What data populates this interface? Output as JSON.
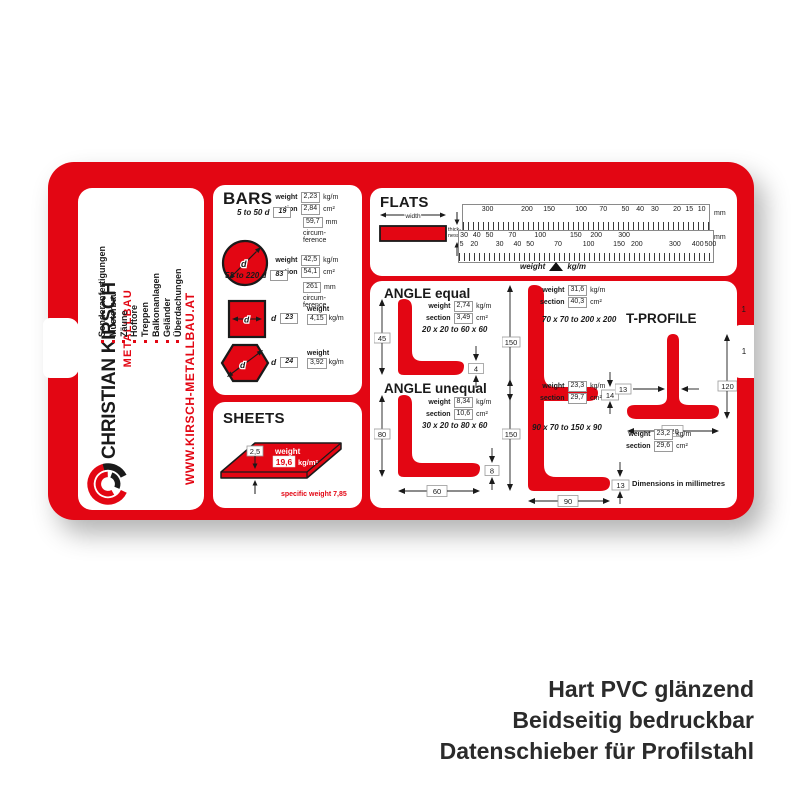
{
  "colors": {
    "red": "#e30613",
    "ink": "#1a1a1a",
    "caption": "#2b2b2b"
  },
  "caption": {
    "lines": [
      "Hart PVC glänzend",
      "Beidseitig bedruckbar",
      "Datenschieber für Profilstahl"
    ]
  },
  "sidebar": {
    "services": [
      "Sonderanfertigungen",
      "Musterbau",
      "Zäune",
      "Hoftore",
      "Treppen",
      "Balkonanlagen",
      "Geländer",
      "Überdachungen"
    ],
    "company": "CHRISTIAN KIRSCH",
    "division": "METALLBAU",
    "website": "WWW.KIRSCH-METALLBAU.AT"
  },
  "labels": {
    "weight": "weight",
    "section": "section",
    "kg_m": "kg/m",
    "cm2": "cm²",
    "kg_m2": "kg/m²",
    "mm": "mm",
    "d": "d",
    "circum": "circum-",
    "ference": "ference",
    "width": "width",
    "thick": "thick-",
    "ness": "ness",
    "specific_weight": "specific weight 7,85",
    "dimensions_note": "Dimensions in millimetres"
  },
  "bars": {
    "title": "BARS",
    "round_small": {
      "range": "5 to 50 d",
      "d": "19",
      "weight": "2,23",
      "section": "2,84",
      "circumference": "59,7"
    },
    "round_large": {
      "range": "52 to 220 d",
      "d": "83",
      "weight": "42,5",
      "section": "54,1",
      "circumference": "261"
    },
    "square": {
      "d": "23",
      "weight": "4,15"
    },
    "hexagon": {
      "d": "24",
      "weight": "3,92"
    }
  },
  "sheets": {
    "title": "SHEETS",
    "thickness": "2,5",
    "weight": "19,6"
  },
  "flats": {
    "title": "FLATS",
    "top_scale": [
      {
        "v": "300",
        "x": 10
      },
      {
        "v": "200",
        "x": 26
      },
      {
        "v": "150",
        "x": 35
      },
      {
        "v": "100",
        "x": 48
      },
      {
        "v": "70",
        "x": 57
      },
      {
        "v": "50",
        "x": 66
      },
      {
        "v": "40",
        "x": 72
      },
      {
        "v": "30",
        "x": 78
      },
      {
        "v": "20",
        "x": 87
      },
      {
        "v": "15",
        "x": 92
      },
      {
        "v": "10",
        "x": 97
      }
    ],
    "mid_scale": [
      {
        "v": "30",
        "x": 2
      },
      {
        "v": "40",
        "x": 7
      },
      {
        "v": "50",
        "x": 12
      },
      {
        "v": "70",
        "x": 21
      },
      {
        "v": "100",
        "x": 32
      },
      {
        "v": "150",
        "x": 46
      },
      {
        "v": "200",
        "x": 54
      },
      {
        "v": "300",
        "x": 65
      }
    ],
    "bottom_scale": [
      {
        "v": "5",
        "x": 1
      },
      {
        "v": "20",
        "x": 6
      },
      {
        "v": "30",
        "x": 16
      },
      {
        "v": "40",
        "x": 23
      },
      {
        "v": "50",
        "x": 28
      },
      {
        "v": "70",
        "x": 39
      },
      {
        "v": "100",
        "x": 51
      },
      {
        "v": "150",
        "x": 63
      },
      {
        "v": "200",
        "x": 70
      },
      {
        "v": "300",
        "x": 85
      },
      {
        "v": "400",
        "x": 94
      },
      {
        "v": "500",
        "x": 99
      }
    ],
    "weight_pointer": "weight",
    "pointer_unit": "kg/m"
  },
  "angles": {
    "equal_title": "ANGLE equal",
    "unequal_title": "ANGLE unequal",
    "eq_small": {
      "weight": "2,74",
      "section": "3,49",
      "range": "20 x 20 to 60 x 60",
      "h": "45",
      "t": "4"
    },
    "eq_large": {
      "weight": "31,6",
      "section": "40,3",
      "range": "70 x 70 to 200 x 200",
      "h": "150",
      "t": "14"
    },
    "uneq_small": {
      "weight": "8,34",
      "section": "10,6",
      "range": "30 x 20 to 80 x 60",
      "h": "80",
      "w": "60",
      "t": "8"
    },
    "uneq_large": {
      "weight": "23,3",
      "section": "29,7",
      "range": "90 x 70 to 150 x 90",
      "h": "150",
      "w": "90",
      "t": "13"
    }
  },
  "tprofile": {
    "title": "T-PROFILE",
    "weight": "23,2",
    "section": "29,6",
    "stem": "13",
    "height": "120",
    "width": "120"
  },
  "slider": {
    "marks": [
      "1",
      "1"
    ]
  }
}
